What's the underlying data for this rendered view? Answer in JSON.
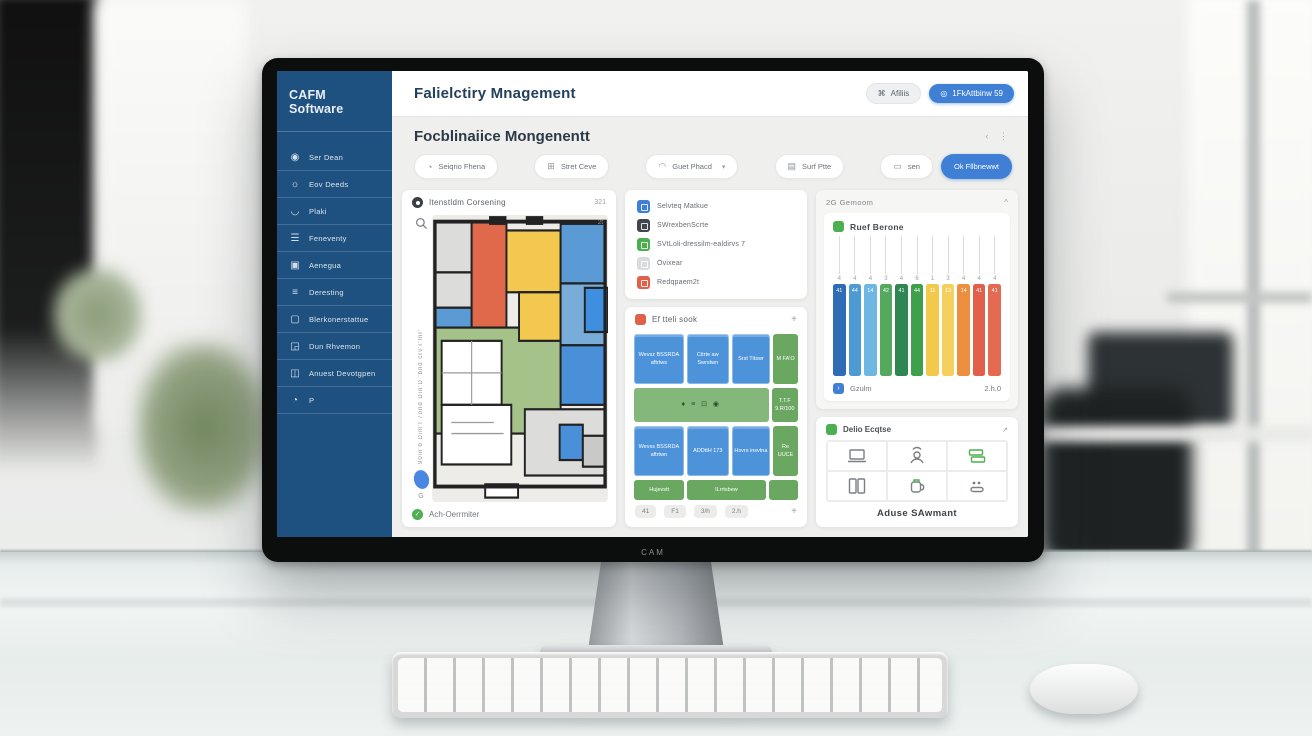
{
  "scene": {
    "monitor_brand": "CAM"
  },
  "sidebar": {
    "title": "CAFM Software",
    "items": [
      {
        "label": "Ser Dean",
        "icon": "user-circle-icon"
      },
      {
        "label": "Eov Deeds",
        "icon": "sun-icon"
      },
      {
        "label": "Plaki",
        "icon": "curve-icon"
      },
      {
        "label": "Feneventy",
        "icon": "sliders-icon"
      },
      {
        "label": "Aenegua",
        "icon": "panel-icon"
      },
      {
        "label": "Deresting",
        "icon": "menu-icon"
      },
      {
        "label": "Blerkonerstattue",
        "icon": "square-icon"
      },
      {
        "label": "Dun Rhvemon",
        "icon": "image-icon"
      },
      {
        "label": "Anuest Devotgpen",
        "icon": "badge-icon"
      },
      {
        "label": "P",
        "icon": "power-icon"
      }
    ]
  },
  "topbar": {
    "title": "Falielctiry Mnagement",
    "secondary_button": "Afiliis",
    "primary_button": "1FkAttbinw 59"
  },
  "page": {
    "heading": "Focblinaiice Mongenentt",
    "nav_arrows": "‹ ⋮",
    "filters": [
      "Seiqrio Fhena",
      "Stret Ceve",
      "Guet Phacd",
      "Surf Ptte",
      "sen"
    ],
    "action_button": "Ok Fllbnewwt"
  },
  "floorplan_card": {
    "title": "Itenstldm Corsening",
    "badge": "321",
    "corner_label": "2t",
    "side_label": "90in'b Dim'l 7ond Din'D 'bnd crv'r'lnr'",
    "g_label": "G",
    "footer": "Ach-Oerrmiter",
    "check_glyph": "✓"
  },
  "legend_card": {
    "items": [
      {
        "label": "Selvteq Matkue",
        "color": "#3d7fd9"
      },
      {
        "label": "SWrexbenScrte",
        "color": "#41464d"
      },
      {
        "label": "SVtLoli-dressilm-ealdirvs 7",
        "color": "#4caf50"
      },
      {
        "label": "Ovixear",
        "color": "#d9dbdd"
      },
      {
        "label": "Redqpaem2t",
        "color": "#e0614a"
      }
    ]
  },
  "schedule_card": {
    "title": "Ef tteli sook",
    "add_label": "+",
    "grid": [
      {
        "h": 50,
        "cells": [
          {
            "c": "blue",
            "t": "Wevsz BSSRDA aftrtws",
            "w": 1.2
          },
          {
            "c": "blue",
            "t": "Citrte aw Swrstwn",
            "w": 1
          },
          {
            "c": "blue",
            "t": "Srst Titswr",
            "w": 0.9
          },
          {
            "c": "green",
            "t": "M FA'O",
            "w": 0.55
          }
        ]
      },
      {
        "h": 34,
        "cells": [
          {
            "c": "greenwide",
            "t": "♦ ≡ ⊡ ◉",
            "w": 3.2
          },
          {
            "c": "green",
            "t": "T.T.F 9.R/100",
            "w": 0.55
          }
        ]
      },
      {
        "h": 50,
        "cells": [
          {
            "c": "blue",
            "t": "Wevss BSSRDA aftrtwn",
            "w": 1.2
          },
          {
            "c": "blue",
            "t": "ADDttH 173",
            "w": 1
          },
          {
            "c": "blue",
            "t": "Hsvrs insvtna",
            "w": 0.9
          },
          {
            "c": "green",
            "t": "Re UUCE",
            "w": 0.55
          }
        ]
      },
      {
        "h": 20,
        "cells": [
          {
            "c": "green",
            "t": "Hujevstt",
            "w": 1
          },
          {
            "c": "green",
            "t": "ILrrtsbew",
            "w": 1.6
          },
          {
            "c": "green",
            "t": "",
            "w": 0.55
          }
        ]
      }
    ],
    "pager": [
      "41",
      "F1",
      "3/h",
      "2.h"
    ],
    "pager_add": "+"
  },
  "chart_card": {
    "group_title": "2G Gemoom",
    "collapse_icon": "^",
    "title": "Ruef Berone",
    "footer_icon_glyph": "›",
    "footer_label": "Gzulm",
    "footer_value": "2.h.0"
  },
  "chart_data": {
    "type": "bar",
    "title": "Ruef Berone",
    "categories": [
      "4",
      "4",
      "4",
      "3",
      "4",
      "6",
      "1",
      "3",
      "4",
      "4",
      "4"
    ],
    "values": [
      41,
      44,
      14,
      42,
      41,
      44,
      11,
      13,
      14,
      41,
      41
    ],
    "bar_colors": [
      "#2e6cb5",
      "#4e9ad2",
      "#6db7e2",
      "#55a95f",
      "#2f8653",
      "#3ea04b",
      "#f3c94b",
      "#f6d05e",
      "#ec8f3f",
      "#e2604a",
      "#e46b52"
    ],
    "bars_equal_height": true,
    "ylim": [
      0,
      50
    ],
    "xlabel": "",
    "ylabel": "",
    "legend_label": "Gzulm",
    "legend_value": "2.h.0",
    "grid": "vertical tick lines above each bar"
  },
  "assets_card": {
    "title": "Delio Ecqtse",
    "corner_label": "↗",
    "caption": "Aduse SAwmant",
    "tiles": [
      "laptop-icon",
      "cloud-person-icon",
      "stacked-boxes-icon",
      "binder-icon",
      "kettle-icon",
      "meter-icon"
    ]
  },
  "floor_plan": {
    "wall_color": "#222222",
    "bg": "#edece8",
    "outline": {
      "x": 3,
      "y": 6,
      "w": 176,
      "h": 240
    },
    "rooms": [
      {
        "x": 3,
        "y": 6,
        "w": 38,
        "h": 46,
        "f": "#dcdcda"
      },
      {
        "x": 3,
        "y": 52,
        "w": 38,
        "h": 32,
        "f": "#dcdcda"
      },
      {
        "x": 3,
        "y": 84,
        "w": 38,
        "h": 36,
        "f": "#5b9bd5"
      },
      {
        "x": 41,
        "y": 6,
        "w": 36,
        "h": 96,
        "f": "#e0684b"
      },
      {
        "x": 3,
        "y": 102,
        "w": 130,
        "h": 96,
        "f": "#a5c28b"
      },
      {
        "x": 77,
        "y": 14,
        "w": 56,
        "h": 56,
        "f": "#f2c84e"
      },
      {
        "x": 90,
        "y": 70,
        "w": 43,
        "h": 44,
        "f": "#f2c84e"
      },
      {
        "x": 133,
        "y": 8,
        "w": 46,
        "h": 54,
        "f": "#5b9bd5"
      },
      {
        "x": 133,
        "y": 62,
        "w": 46,
        "h": 56,
        "f": "#79add9"
      },
      {
        "x": 158,
        "y": 66,
        "w": 24,
        "h": 40,
        "f": "#3f8fe0"
      },
      {
        "x": 133,
        "y": 118,
        "w": 46,
        "h": 54,
        "f": "#4a90d9"
      },
      {
        "x": 10,
        "y": 114,
        "w": 62,
        "h": 58,
        "f": "#ffffff"
      },
      {
        "x": 10,
        "y": 172,
        "w": 72,
        "h": 54,
        "f": "#ffffff"
      },
      {
        "x": 96,
        "y": 176,
        "w": 83,
        "h": 60,
        "f": "#dcdcda"
      },
      {
        "x": 132,
        "y": 190,
        "w": 24,
        "h": 32,
        "f": "#4a90d9"
      },
      {
        "x": 156,
        "y": 200,
        "w": 23,
        "h": 28,
        "f": "#c9c9c7"
      },
      {
        "x": 55,
        "y": 244,
        "w": 34,
        "h": 12,
        "f": "#ffffff"
      },
      {
        "x": 60,
        "y": 2,
        "w": 16,
        "h": 6,
        "f": "#222222"
      },
      {
        "x": 98,
        "y": 2,
        "w": 16,
        "h": 6,
        "f": "#222222"
      }
    ],
    "lines": [
      {
        "x1": 41,
        "y1": 114,
        "x2": 41,
        "y2": 172
      },
      {
        "x1": 10,
        "y1": 143,
        "x2": 72,
        "y2": 143
      },
      {
        "x1": 20,
        "y1": 188,
        "x2": 64,
        "y2": 188
      },
      {
        "x1": 20,
        "y1": 198,
        "x2": 74,
        "y2": 198
      }
    ]
  }
}
